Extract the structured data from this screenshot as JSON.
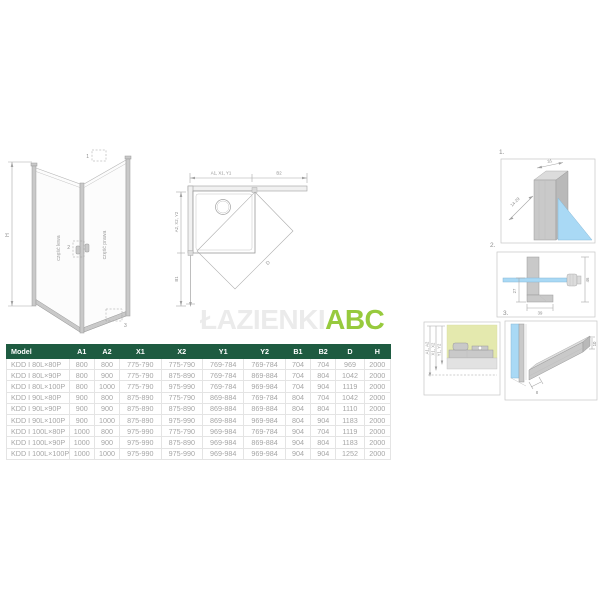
{
  "colors": {
    "header_green": "#1e5b41",
    "brand_green": "#97ca3d",
    "watermark_gray": "#ebebeb",
    "glass_blue": "#a9d9f5",
    "wall_yellow": "#e4e9ae",
    "cell_text": "#a6a6a6"
  },
  "brand": {
    "watermark": "ŁAZIENKI",
    "name": "ABC"
  },
  "iso_view": {
    "height_label": "H",
    "left_panel_label": "część lewa",
    "right_panel_label": "część prawa",
    "callout_top": "1",
    "callout_handle": "2",
    "callout_bottom": "3"
  },
  "plan_view": {
    "dim_top_left": "A1, X1, Y1",
    "dim_top_right": "B2",
    "dim_left_top": "A2, X2, Y2",
    "dim_left_bottom": "B1",
    "dim_diagonal": "D"
  },
  "details": {
    "d1": {
      "label": "1.",
      "dim_width": "31",
      "dim_range": "14-29"
    },
    "d2": {
      "label": "2.",
      "dim_left": "27",
      "dim_bottom": "39",
      "dim_right": "46"
    },
    "d3": {
      "label": "3.",
      "dim_bottom": "8",
      "dim_side": "10"
    },
    "wall_ref": {
      "dim_outer": "A1, A2",
      "dim_middle": "X1, X2",
      "dim_inner": "Y1, Y2"
    }
  },
  "table": {
    "headers": [
      "Model",
      "A1",
      "A2",
      "X1",
      "X2",
      "Y1",
      "Y2",
      "B1",
      "B2",
      "D",
      "H"
    ],
    "rows": [
      [
        "KDD I 80L×80P",
        "800",
        "800",
        "775-790",
        "775-790",
        "769-784",
        "769-784",
        "704",
        "704",
        "969",
        "2000"
      ],
      [
        "KDD I 80L×90P",
        "800",
        "900",
        "775-790",
        "875-890",
        "769-784",
        "869-884",
        "704",
        "804",
        "1042",
        "2000"
      ],
      [
        "KDD I 80L×100P",
        "800",
        "1000",
        "775-790",
        "975-990",
        "769-784",
        "969-984",
        "704",
        "904",
        "1119",
        "2000"
      ],
      [
        "KDD I 90L×80P",
        "900",
        "800",
        "875-890",
        "775-790",
        "869-884",
        "769-784",
        "804",
        "704",
        "1042",
        "2000"
      ],
      [
        "KDD I 90L×90P",
        "900",
        "900",
        "875-890",
        "875-890",
        "869-884",
        "869-884",
        "804",
        "804",
        "1110",
        "2000"
      ],
      [
        "KDD I 90L×100P",
        "900",
        "1000",
        "875-890",
        "975-990",
        "869-884",
        "969-984",
        "804",
        "904",
        "1183",
        "2000"
      ],
      [
        "KDD I 100L×80P",
        "1000",
        "800",
        "975-990",
        "775-790",
        "969-984",
        "769-784",
        "904",
        "704",
        "1119",
        "2000"
      ],
      [
        "KDD I 100L×90P",
        "1000",
        "900",
        "975-990",
        "875-890",
        "969-984",
        "869-884",
        "904",
        "804",
        "1183",
        "2000"
      ],
      [
        "KDD I 100L×100P",
        "1000",
        "1000",
        "975-990",
        "975-990",
        "969-984",
        "969-984",
        "904",
        "904",
        "1252",
        "2000"
      ]
    ]
  }
}
